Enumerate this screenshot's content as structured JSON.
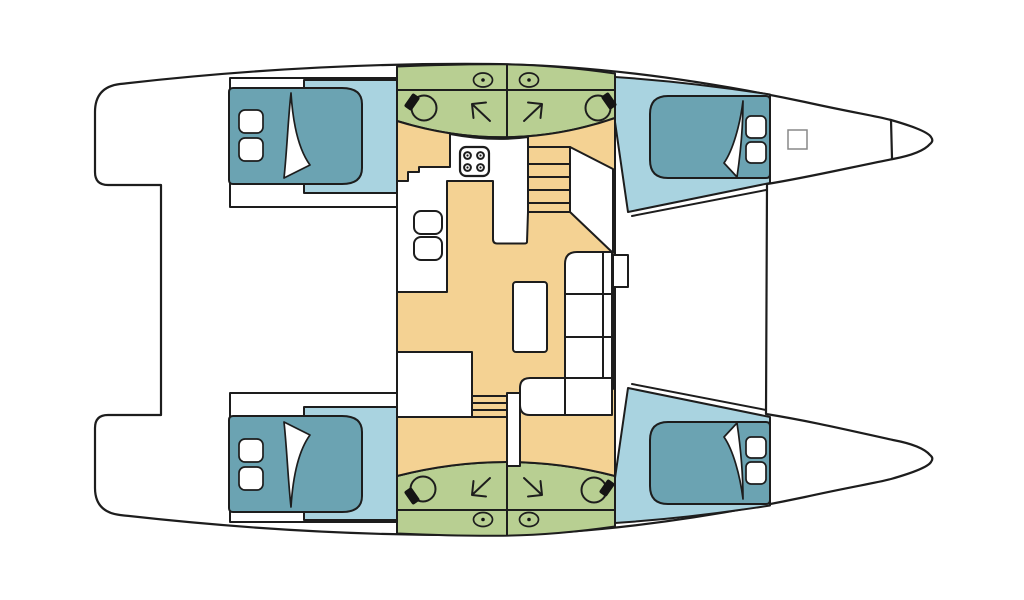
{
  "plan": {
    "type": "catamaran-deck-plan",
    "orientation": {
      "bow": "right",
      "stern": "left"
    },
    "colors": {
      "background": "#ffffff",
      "deck": "#ffffff",
      "outline": "#1d1d1d",
      "cabin_floor": "#a9d3e0",
      "bed": "#6ba3b2",
      "bathroom": "#b8cf92",
      "salon_floor": "#f4d293",
      "furniture": "#ffffff",
      "fixture_dark": "#141414"
    },
    "rooms": {
      "double_cabins": 4,
      "bathrooms": 4,
      "salon": 1,
      "cockpit": 1
    },
    "fixtures": {
      "beds": 4,
      "pillows": 8,
      "toilets": 4,
      "showers": 4,
      "sinks": 4,
      "stove_burners": 4,
      "staircases": 2,
      "salon_table": 1,
      "sofa_sections": 5,
      "chart_seats": 2,
      "deck_hatches": 1
    }
  }
}
